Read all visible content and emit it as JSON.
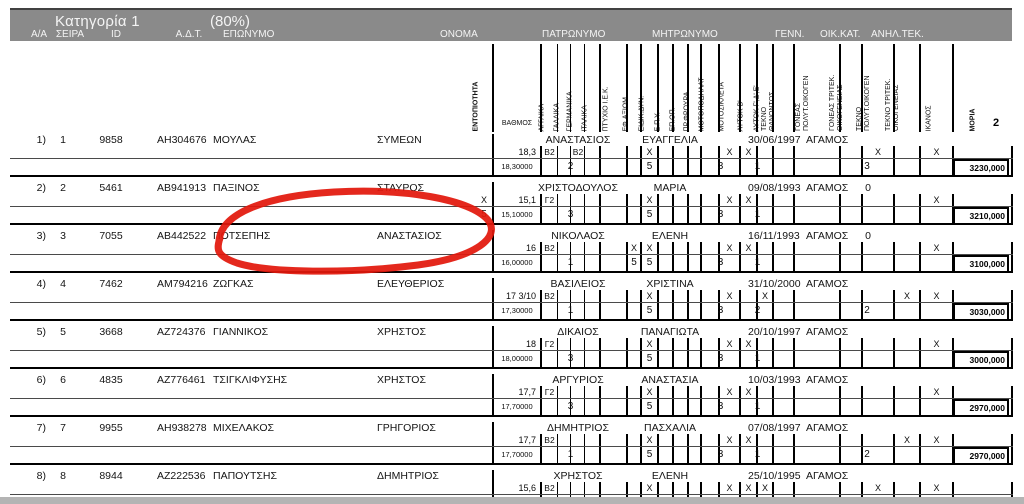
{
  "band": {
    "title": "Κατηγορία 1",
    "percent": "(80%)",
    "labels": [
      "Α/Α",
      "ΣΕΙΡΑ",
      "ID",
      "Α.Δ.Τ.",
      "ΕΠΩΝΥΜΟ",
      "ΟΝΟΜΑ",
      "ΠΑΤΡΩΝΥΜΟ",
      "ΜΗΤΡΩΝΥΜΟ",
      "ΓΕΝΝ.",
      "ΟΙΚ.ΚΑΤ.",
      "ΑΝΗΛ.ΤΕΚ."
    ]
  },
  "mini_columns": [
    {
      "key": "entopiotita",
      "lines": [
        "ΕΝΤΟΠΙΟΤΗΤΑ"
      ],
      "bold": true
    },
    {
      "key": "vathmos",
      "lines": [
        "ΒΑΘΜΟΣ"
      ],
      "horizontal": true
    },
    {
      "key": "agglika",
      "lines": [
        "ΑΓΓΛΙΚΑ"
      ]
    },
    {
      "key": "gallika",
      "lines": [
        "ΓΑΛΛΙΚΑ"
      ]
    },
    {
      "key": "germanika",
      "lines": [
        "ΓΕΡΜΑΝΙΚΑ"
      ]
    },
    {
      "key": "italika",
      "lines": [
        "ΙΤΑΛΙΚΑ"
      ]
    },
    {
      "key": "ptyxio_iek",
      "lines": [
        "ΠΤΥΧΙΟ Ι.Ε.Κ."
      ]
    },
    {
      "key": "eph_axiom",
      "lines": [
        "ΕΦ.ΑΞΙΩΜ."
      ]
    },
    {
      "key": "eidik_dyn",
      "lines": [
        "ΕΙΔΙΚ.ΔΥΝ."
      ]
    },
    {
      "key": "epy",
      "lines": [
        "Ε.Π.Υ."
      ]
    },
    {
      "key": "ep_op",
      "lines": [
        "ΕΠ.ΟΠ."
      ]
    },
    {
      "key": "pr_froura",
      "lines": [
        "ΠΡ.ΦΡΟΥΡΑ"
      ]
    },
    {
      "key": "motopodilat",
      "lines": [
        "ΜΟΤΟΠΟΔΗΛΑΤ"
      ]
    },
    {
      "key": "motosikleta",
      "lines": [
        "ΜΟΤΟΣΙΚΛΕΤΑ"
      ]
    },
    {
      "key": "aytok_b",
      "lines": [
        "ΑΥΤΟΚ Β'"
      ]
    },
    {
      "key": "aytok_gde",
      "lines": [
        "ΑΥΤΟΚ Γ',Δ',Ε'"
      ]
    },
    {
      "key": "tekno_than",
      "lines": [
        "ΤΕΚΝΟ",
        "ΘΑΝΟΝΤΟΣ"
      ]
    },
    {
      "key": "goneas_polyt",
      "lines": [
        "ΓΟΝΕΑΣ",
        "ΠΟΛΥΤ.ΟΙΚΟΓΕΝ"
      ]
    },
    {
      "key": "goneas_tritek",
      "lines": [
        "ΓΟΝΕΑΣ ΤΡΙΤΕΚ.",
        "ΟΙΚΟΓΕΝΕΙΑΣ"
      ]
    },
    {
      "key": "tekno_polyt",
      "lines": [
        "ΤΕΚΝΟ",
        "ΠΟΛΥΤ.ΟΙΚΟΓΕΝ"
      ]
    },
    {
      "key": "tekno_tritek",
      "lines": [
        "ΤΕΚΝΟ ΤΡΙΤΕΚ.",
        "ΟΙΚΟΓΕΝΕΙΑΣ"
      ]
    },
    {
      "key": "ikanos",
      "lines": [
        "ΙΚΑΝΟΣ"
      ]
    },
    {
      "key": "moria",
      "lines": [
        "ΜΟΡΙΑ"
      ],
      "bold": true
    }
  ],
  "rows": [
    {
      "num": "1)",
      "seira": "1",
      "id": "9858",
      "adt": "ΑΗ304676",
      "eponymo": "ΜΟΥΛΑΣ",
      "onoma": "ΣΥΜΕΩΝ",
      "patronymo": "ΑΝΑΣΤΑΣΙΟΣ",
      "mitronymo": "ΕΥΑΓΓΕΛΙΑ",
      "genn": "30/06/1997",
      "oik_kat": "ΑΓΑΜΟΣ",
      "anil_tek": "",
      "marks": {
        "vathmos": "18,3",
        "agglika": "B2",
        "germanika": "B2",
        "eidik_dyn": "X",
        "motosikleta": "X",
        "aytok_b": "X",
        "tekno_polyt": "X",
        "ikanos": "X"
      },
      "calc": {
        "vathmos": "18,30000",
        "languages": "2",
        "eidik_dyn": "5",
        "moto": "3",
        "aytok": "1",
        "family": "3",
        "moria": "3230,000"
      }
    },
    {
      "num": "2)",
      "seira": "2",
      "id": "5461",
      "adt": "ΑΒ941913",
      "eponymo": "ΠΑΞΙΝΟΣ",
      "onoma": "ΣΤΑΥΡΟΣ",
      "patronymo": "ΧΡΙΣΤΟΔΟΥΛΟΣ",
      "mitronymo": "ΜΑΡΙΑ",
      "genn": "09/08/1993",
      "oik_kat": "ΑΓΑΜΟΣ",
      "anil_tek": "0",
      "marks": {
        "entopiotita": "X",
        "vathmos": "15,1",
        "agglika": "Γ2",
        "eidik_dyn": "X",
        "motosikleta": "X",
        "aytok_b": "X",
        "ikanos": "X"
      },
      "calc": {
        "entopiotita": "5",
        "vathmos": "15,10000",
        "languages": "3",
        "eidik_dyn": "5",
        "moto": "3",
        "aytok": "1",
        "moria": "3210,000"
      }
    },
    {
      "num": "3)",
      "seira": "3",
      "id": "7055",
      "adt": "ΑΒ442522",
      "eponymo": "ΠΟΤΣΕΠΗΣ",
      "onoma": "ΑΝΑΣΤΑΣΙΟΣ",
      "patronymo": "ΝΙΚΟΛΑΟΣ",
      "mitronymo": "ΕΛΕΝΗ",
      "genn": "16/11/1993",
      "oik_kat": "ΑΓΑΜΟΣ",
      "anil_tek": "0",
      "circled": true,
      "marks": {
        "vathmos": "16",
        "agglika": "B2",
        "eph_axiom": "X",
        "eidik_dyn": "X",
        "motosikleta": "X",
        "aytok_b": "X",
        "ikanos": "X"
      },
      "calc": {
        "vathmos": "16,00000",
        "languages": "1",
        "eph_axiom": "5",
        "eidik_dyn": "5",
        "moto": "3",
        "aytok": "1",
        "moria": "3100,000"
      }
    },
    {
      "num": "4)",
      "seira": "4",
      "id": "7462",
      "adt": "ΑΜ794216",
      "eponymo": "ΖΩΓΚΑΣ",
      "onoma": "ΕΛΕΥΘΕΡΙΟΣ",
      "patronymo": "ΒΑΣΙΛΕΙΟΣ",
      "mitronymo": "ΧΡΙΣΤΙΝΑ",
      "genn": "31/10/2000",
      "oik_kat": "ΑΓΑΜΟΣ",
      "anil_tek": "",
      "marks": {
        "vathmos": "17 3/10",
        "agglika": "B2",
        "eidik_dyn": "X",
        "motosikleta": "X",
        "aytok_gde": "X",
        "tekno_tritek": "X",
        "ikanos": "X"
      },
      "calc": {
        "vathmos": "17,30000",
        "languages": "1",
        "eidik_dyn": "5",
        "moto": "3",
        "aytok": "2",
        "family": "2",
        "moria": "3030,000"
      }
    },
    {
      "num": "5)",
      "seira": "5",
      "id": "3668",
      "adt": "ΑΖ724376",
      "eponymo": "ΓΙΑΝΝΙΚΟΣ",
      "onoma": "ΧΡΗΣΤΟΣ",
      "patronymo": "ΔΙΚΑΙΟΣ",
      "mitronymo": "ΠΑΝΑΓΙΩΤΑ",
      "genn": "20/10/1997",
      "oik_kat": "ΑΓΑΜΟΣ",
      "anil_tek": "",
      "marks": {
        "vathmos": "18",
        "agglika": "Γ2",
        "eidik_dyn": "X",
        "motosikleta": "X",
        "aytok_b": "X",
        "ikanos": "X"
      },
      "calc": {
        "vathmos": "18,00000",
        "languages": "3",
        "eidik_dyn": "5",
        "moto": "3",
        "aytok": "1",
        "moria": "3000,000"
      }
    },
    {
      "num": "6)",
      "seira": "6",
      "id": "4835",
      "adt": "ΑΖ776461",
      "eponymo": "ΤΣΙΓΚΛΙΦΥΣΗΣ",
      "onoma": "ΧΡΗΣΤΟΣ",
      "patronymo": "ΑΡΓΥΡΙΟΣ",
      "mitronymo": "ΑΝΑΣΤΑΣΙΑ",
      "genn": "10/03/1993",
      "oik_kat": "ΑΓΑΜΟΣ",
      "anil_tek": "",
      "marks": {
        "vathmos": "17,7",
        "agglika": "Γ2",
        "eidik_dyn": "X",
        "motosikleta": "X",
        "aytok_b": "X",
        "ikanos": "X"
      },
      "calc": {
        "vathmos": "17,70000",
        "languages": "3",
        "eidik_dyn": "5",
        "moto": "3",
        "aytok": "1",
        "moria": "2970,000"
      }
    },
    {
      "num": "7)",
      "seira": "7",
      "id": "9955",
      "adt": "ΑΗ938278",
      "eponymo": "ΜΙΧΕΛΑΚΟΣ",
      "onoma": "ΓΡΗΓΟΡΙΟΣ",
      "patronymo": "ΔΗΜΗΤΡΙΟΣ",
      "mitronymo": "ΠΑΣΧΑΛΙΑ",
      "genn": "07/08/1997",
      "oik_kat": "ΑΓΑΜΟΣ",
      "anil_tek": "",
      "marks": {
        "vathmos": "17,7",
        "agglika": "B2",
        "eidik_dyn": "X",
        "motosikleta": "X",
        "aytok_b": "X",
        "tekno_tritek": "X",
        "ikanos": "X"
      },
      "calc": {
        "vathmos": "17,70000",
        "languages": "1",
        "eidik_dyn": "5",
        "moto": "3",
        "aytok": "1",
        "family": "2",
        "moria": "2970,000"
      }
    },
    {
      "num": "8)",
      "seira": "8",
      "id": "8944",
      "adt": "ΑΖ222536",
      "eponymo": "ΠΑΠΟΥΤΣΗΣ",
      "onoma": "ΔΗΜΗΤΡΙΟΣ",
      "patronymo": "ΧΡΗΣΤΟΣ",
      "mitronymo": "ΕΛΕΝΗ",
      "genn": "25/10/1995",
      "oik_kat": "ΑΓΑΜΟΣ",
      "anil_tek": "",
      "marks": {
        "vathmos": "15,6",
        "agglika": "B2",
        "eidik_dyn": "X",
        "motosikleta": "X",
        "aytok_b": "X",
        "aytok_gde": "X",
        "tekno_polyt": "X",
        "ikanos": "X"
      },
      "calc": {}
    }
  ],
  "annotation": {
    "shape": "hand-drawn-red-circle",
    "around": "ΠΟΤΣΕΠΗΣ",
    "color": "#e2180c"
  },
  "stray_mark": "2",
  "colors": {
    "band_bg": "#8a8a8a",
    "band_text": "#f4f4f4",
    "page_bg": "#ffffff",
    "outer_bg": "#b4b4b4",
    "ink": "#141414",
    "annotation_red": "#e2180c"
  }
}
